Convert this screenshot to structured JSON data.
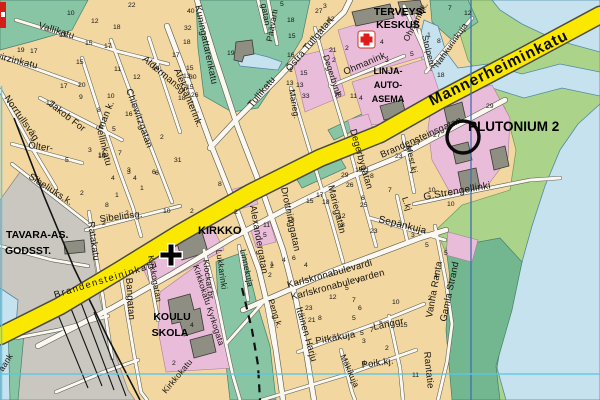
{
  "map_title": "town street map with PLUTONIUM 2 marker",
  "colors": {
    "land": "#f2d7a0",
    "water": "#c6e2ee",
    "park_teal": "#87c5a5",
    "park_green": "#abd389",
    "shore_green": "#72b78f",
    "road_yellow": "#fae800",
    "block_pink": "#e9bcd9",
    "building_gray": "#8e8e82",
    "rail_gray": "#c9c7c0",
    "grid_blue": "#3b6fb5",
    "grid_cyan": "#5ac8e6",
    "cross_red": "#e01b1b",
    "label_black": "#17140f"
  },
  "pois": {
    "terveys1": "TERVEYS-",
    "terveys2": "KESKUS",
    "linja1": "LINJA-",
    "linja2": "AUTO-",
    "linja3": "ASEMA",
    "kirkko": "KIRKKO",
    "koulu1": "KOULU",
    "koulu2": "SKOLA",
    "tavara1": "TAVARA-AS.",
    "tavara2": "GODSST.",
    "plutonium": "PLUTONIUM 2"
  },
  "streets": {
    "mannerheiminkatu": "Mannerheiminkatu",
    "brandensteininkatu": "Brandensteininkatu",
    "brandensteinsgatan": "Brandensteinsgatan",
    "vallikatu": "Vallikatu",
    "wirzinkatu": "wirzinkatu",
    "kuningattarenkatu": "Kuningattarenkatu",
    "aldermansg": "Aldermansg.",
    "aleksanterink": "Aleksanterink.",
    "norrtullsvag": "Norrtullsväg",
    "jakob_for": "Jakob For",
    "sellinkatu": "sellinkatu",
    "olter": "Olter-",
    "man_k": "man k.",
    "chiewitzgatan": "Chiewitzgatan",
    "sibeliuks_k": "Sibeliuks.k.",
    "sibeliusg": "Sibeliusg.",
    "ratakatu": "Ratakatu",
    "bangatan": "Bangatan",
    "kirkkogatan": "Kirkkogatan",
    "kirkkokatu_kyrkogata": "Kirkkokatu Kyrkogata",
    "kirkkokatu": "Kirkkokatu",
    "klockar_br": "Klockar.br.",
    "lukkarinki": "Lukkarinki",
    "linnekuja": "Linnekuja",
    "alexandergatan": "Alexandergatan",
    "drottninggatan": "Drottninggatan",
    "marieg": "Marieg.",
    "mariegatan": "Mariegatan",
    "degerbynk": "Degerbynk.",
    "degerbygatan": "Degerbygatan",
    "ostra_tullgatan": "Östra Tullgatan",
    "tullikatu": "Tullikatu",
    "paavarti": "Päävarti",
    "gatan": "gatan",
    "ohmanink": "Ohmanink.",
    "ohmanink2": "Ohmanink.",
    "stolpenk": "Stolpenk.",
    "nahkurinkuja": "Nahkurinkuja",
    "mest_kj": "Mest.kj",
    "g_strengellinki": "G.Strengellinki",
    "l_kj": "L.kj",
    "sepankuja": "Sepänkuja",
    "karlskronabulevardi": "Karlskronabulevardi",
    "karlskronabulevarden": "Karlskronabulevarden",
    "itainen_harju": "Itäinen Harju",
    "peng_k": "Peng.k.",
    "pitkakuja": "Pitkäkuja",
    "langgr": "Långgr.",
    "poik_kj": "Poik.kj.",
    "makikuja": "Mäkikuja",
    "vanha_ranta": "Vanha Ranta",
    "gamla_strand": "Gamla Strand",
    "rantatie": "Rantatie",
    "aank": "aank"
  },
  "house_numbers": [
    [
      67,
      15,
      "10"
    ],
    [
      91,
      23,
      "12"
    ],
    [
      113,
      29,
      "18"
    ],
    [
      59,
      37,
      "13"
    ],
    [
      85,
      45,
      "15"
    ],
    [
      104,
      48,
      "17"
    ],
    [
      17,
      52,
      "19"
    ],
    [
      30,
      53,
      "17"
    ],
    [
      76,
      64,
      "15"
    ],
    [
      114,
      71,
      "11"
    ],
    [
      133,
      79,
      "12"
    ],
    [
      152,
      70,
      "14"
    ],
    [
      172,
      57,
      "17"
    ],
    [
      128,
      7,
      "22"
    ],
    [
      60,
      88,
      "17"
    ],
    [
      78,
      87,
      "20"
    ],
    [
      79,
      99,
      "9"
    ],
    [
      97,
      112,
      "8"
    ],
    [
      107,
      98,
      "10"
    ],
    [
      125,
      116,
      "16"
    ],
    [
      46,
      105,
      "12"
    ],
    [
      112,
      131,
      "5"
    ],
    [
      88,
      152,
      "3"
    ],
    [
      98,
      157,
      "10"
    ],
    [
      118,
      155,
      "7"
    ],
    [
      127,
      174,
      "3"
    ],
    [
      133,
      180,
      "4"
    ],
    [
      152,
      174,
      "6"
    ],
    [
      160,
      139,
      "2"
    ],
    [
      174,
      162,
      "31"
    ],
    [
      183,
      78,
      "13"
    ],
    [
      186,
      89,
      "15"
    ],
    [
      178,
      100,
      "18"
    ],
    [
      187,
      13,
      "40"
    ],
    [
      184,
      30,
      "32"
    ],
    [
      183,
      44,
      "18"
    ],
    [
      186,
      70,
      "15"
    ],
    [
      189,
      79,
      "30"
    ],
    [
      191,
      97,
      "26"
    ],
    [
      227,
      55,
      "19"
    ],
    [
      280,
      6,
      "5"
    ],
    [
      287,
      22,
      "18"
    ],
    [
      288,
      38,
      "15"
    ],
    [
      287,
      57,
      "16"
    ],
    [
      289,
      72,
      "1"
    ],
    [
      286,
      85,
      "13"
    ],
    [
      315,
      13,
      "27"
    ],
    [
      323,
      8,
      "3"
    ],
    [
      327,
      21,
      "12"
    ],
    [
      329,
      52,
      "21"
    ],
    [
      332,
      62,
      "2"
    ],
    [
      300,
      75,
      "15"
    ],
    [
      296,
      87,
      "13"
    ],
    [
      302,
      98,
      "33"
    ],
    [
      334,
      97,
      "70"
    ],
    [
      448,
      10,
      "7"
    ],
    [
      464,
      15,
      "12"
    ],
    [
      427,
      37,
      "1"
    ],
    [
      437,
      43,
      "8"
    ],
    [
      410,
      56,
      "5"
    ],
    [
      380,
      44,
      "4"
    ],
    [
      385,
      62,
      "3"
    ],
    [
      345,
      50,
      "2"
    ],
    [
      350,
      98,
      "11"
    ],
    [
      359,
      100,
      "4"
    ],
    [
      437,
      77,
      "18"
    ],
    [
      486,
      108,
      "29"
    ],
    [
      433,
      137,
      "27"
    ],
    [
      428,
      192,
      "10"
    ],
    [
      395,
      158,
      "23"
    ],
    [
      404,
      151,
      "25"
    ],
    [
      413,
      145,
      "27"
    ],
    [
      355,
      172,
      "19"
    ],
    [
      362,
      172,
      "21"
    ],
    [
      370,
      178,
      "8"
    ],
    [
      341,
      177,
      "29"
    ],
    [
      346,
      187,
      "26"
    ],
    [
      360,
      207,
      "25"
    ],
    [
      338,
      218,
      "12"
    ],
    [
      341,
      227,
      "8"
    ],
    [
      361,
      200,
      "6"
    ],
    [
      388,
      192,
      "7"
    ],
    [
      370,
      233,
      "23"
    ],
    [
      447,
      206,
      "10"
    ],
    [
      411,
      237,
      "3"
    ],
    [
      425,
      247,
      "5"
    ],
    [
      163,
      213,
      "10"
    ],
    [
      190,
      213,
      "2"
    ],
    [
      234,
      214,
      "2"
    ],
    [
      218,
      186,
      "8"
    ],
    [
      263,
      227,
      "11"
    ],
    [
      263,
      237,
      "5"
    ],
    [
      287,
      222,
      "13"
    ],
    [
      306,
      203,
      "15"
    ],
    [
      316,
      197,
      "17"
    ],
    [
      322,
      204,
      "18"
    ],
    [
      270,
      266,
      "1"
    ],
    [
      268,
      277,
      "2"
    ],
    [
      282,
      262,
      "4"
    ],
    [
      292,
      260,
      "6"
    ],
    [
      65,
      162,
      "5"
    ],
    [
      98,
      158,
      "10"
    ],
    [
      127,
      172,
      "3"
    ],
    [
      111,
      180,
      "4"
    ],
    [
      80,
      195,
      "2"
    ],
    [
      115,
      197,
      "1"
    ],
    [
      105,
      207,
      "8"
    ],
    [
      125,
      215,
      "2"
    ],
    [
      155,
      175,
      "6"
    ],
    [
      140,
      190,
      "1"
    ],
    [
      102,
      225,
      "2"
    ],
    [
      190,
      327,
      "4"
    ],
    [
      172,
      365,
      "2"
    ],
    [
      305,
      310,
      "23"
    ],
    [
      308,
      322,
      "21"
    ],
    [
      318,
      320,
      "8"
    ],
    [
      329,
      299,
      "12"
    ],
    [
      345,
      290,
      "5"
    ],
    [
      357,
      283,
      "7"
    ],
    [
      352,
      302,
      "7"
    ],
    [
      358,
      310,
      "6"
    ],
    [
      352,
      320,
      "5"
    ],
    [
      400,
      327,
      "15"
    ],
    [
      392,
      304,
      "10"
    ],
    [
      360,
      335,
      "5"
    ],
    [
      362,
      343,
      "3"
    ],
    [
      370,
      332,
      "7"
    ],
    [
      385,
      350,
      "2"
    ],
    [
      362,
      365,
      "4"
    ],
    [
      412,
      377,
      "11"
    ],
    [
      270,
      268,
      "2"
    ],
    [
      304,
      267,
      "4"
    ],
    [
      428,
      300,
      "2"
    ],
    [
      434,
      278,
      "4"
    ],
    [
      444,
      255,
      "5"
    ]
  ]
}
